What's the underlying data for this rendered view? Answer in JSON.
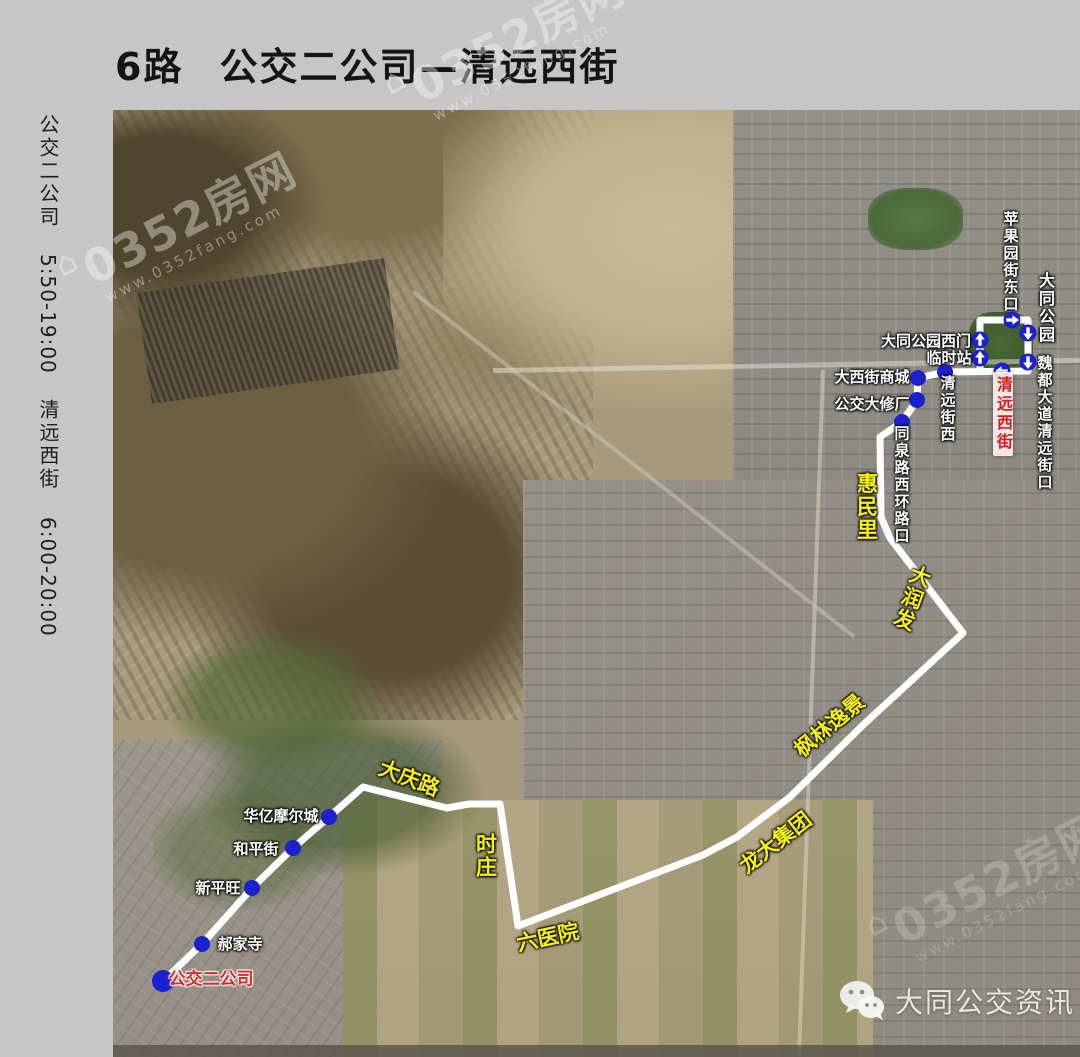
{
  "page": {
    "background": "#c6c6c6"
  },
  "header": {
    "route_no": "6路",
    "route_name": "公交二公司—清远西街"
  },
  "sidebar": {
    "start_name": "公交二公司",
    "start_hours": "5:50-19:00",
    "end_name": "清远西街",
    "end_hours": "6:00-20:00"
  },
  "watermark": {
    "icon": "⌂",
    "text": "0352房网",
    "url": "www.0352fang.com"
  },
  "footer": {
    "brand": "大同公交资讯"
  },
  "map": {
    "colors": {
      "route": "#ffffff",
      "stop": "#1b21cf",
      "station_text": "#ffffff",
      "road_text": "#f9f500",
      "terminal_text": "#e22525",
      "badge_text": "#d11f1f"
    },
    "route": {
      "main": [
        [
          50,
          871
        ],
        [
          89,
          834
        ],
        [
          139,
          778
        ],
        [
          180,
          738
        ],
        [
          216,
          707
        ],
        [
          250,
          677
        ],
        [
          334,
          698
        ],
        [
          356,
          694
        ],
        [
          387,
          694
        ],
        [
          405,
          816
        ],
        [
          590,
          745
        ],
        [
          624,
          727
        ],
        [
          677,
          687
        ],
        [
          750,
          615
        ],
        [
          850,
          523
        ],
        [
          777,
          428
        ],
        [
          768,
          407
        ],
        [
          767,
          327
        ],
        [
          789,
          312
        ],
        [
          804,
          290
        ],
        [
          805,
          268
        ],
        [
          832,
          262
        ],
        [
          915,
          261
        ]
      ],
      "loop": "M 867,261 L 867,210 L 915,210 L 915,261",
      "width": 7
    },
    "dots": [
      {
        "name": "公交二公司",
        "x": 50,
        "y": 871,
        "r": 11
      },
      {
        "name": "郝家寺",
        "x": 89,
        "y": 834,
        "r": 8
      },
      {
        "name": "新平旺",
        "x": 139,
        "y": 778,
        "r": 8
      },
      {
        "name": "和平街",
        "x": 180,
        "y": 738,
        "r": 8
      },
      {
        "name": "华亿摩尔城",
        "x": 216,
        "y": 707,
        "r": 8
      },
      {
        "name": "同泉路西环路口",
        "x": 789,
        "y": 312,
        "r": 8
      },
      {
        "name": "公交大修厂",
        "x": 804,
        "y": 290,
        "r": 8
      },
      {
        "name": "大西街商城",
        "x": 805,
        "y": 268,
        "r": 8
      },
      {
        "name": "清远街西",
        "x": 832,
        "y": 262,
        "r": 8
      },
      {
        "name": "loop-up-1",
        "x": 867,
        "y": 248,
        "r": 8.5,
        "arrow": "up"
      },
      {
        "name": "loop-up-2",
        "x": 867,
        "y": 230,
        "r": 8.5,
        "arrow": "up"
      },
      {
        "name": "loop-right",
        "x": 899,
        "y": 210,
        "r": 8.5,
        "arrow": "right"
      },
      {
        "name": "loop-down-1",
        "x": 915,
        "y": 223,
        "r": 8.5,
        "arrow": "down"
      },
      {
        "name": "loop-down-2",
        "x": 915,
        "y": 252,
        "r": 8.5,
        "arrow": "down"
      },
      {
        "name": "loop-left",
        "x": 889,
        "y": 261,
        "r": 8.5,
        "arrow": "left"
      }
    ],
    "labels": [
      {
        "text": "苹果园街东口",
        "x": 897,
        "y": 152,
        "mode": "v",
        "cls": "white",
        "size": 15
      },
      {
        "text": "大同公园",
        "x": 932,
        "y": 198,
        "mode": "v",
        "cls": "white",
        "size": 16
      },
      {
        "text": "大同公园西门",
        "x": 813,
        "y": 231,
        "mode": "h",
        "cls": "white",
        "size": 15
      },
      {
        "text": "临时站",
        "x": 836,
        "y": 248,
        "mode": "h",
        "cls": "white",
        "size": 15
      },
      {
        "text": "魏都大道清远街口",
        "x": 931,
        "y": 313,
        "mode": "v",
        "cls": "white",
        "size": 15
      },
      {
        "text": "清远西街",
        "x": 890,
        "y": 304,
        "mode": "v",
        "cls": "red-badge",
        "size": 16,
        "name": "destination-badge"
      },
      {
        "text": "大西街商城",
        "x": 759,
        "y": 267,
        "mode": "h",
        "cls": "white",
        "size": 15
      },
      {
        "text": "公交大修厂",
        "x": 759,
        "y": 294,
        "mode": "h",
        "cls": "white",
        "size": 15
      },
      {
        "text": "清远街西",
        "x": 834,
        "y": 299,
        "mode": "v",
        "cls": "white",
        "size": 15
      },
      {
        "text": "同泉路西环路口",
        "x": 788,
        "y": 375,
        "mode": "v",
        "cls": "white",
        "size": 15
      },
      {
        "text": "惠民里",
        "x": 753,
        "y": 397,
        "mode": "v",
        "cls": "yellow",
        "size": 21
      },
      {
        "text": "大润发",
        "x": 798,
        "y": 488,
        "mode": "v",
        "cls": "yellow",
        "size": 21,
        "rot": 20
      },
      {
        "text": "枫林逸景",
        "x": 717,
        "y": 616,
        "mode": "h",
        "cls": "yellow",
        "size": 21,
        "rot": -40
      },
      {
        "text": "龙大集团",
        "x": 663,
        "y": 733,
        "mode": "h",
        "cls": "yellow",
        "size": 21,
        "rot": -38
      },
      {
        "text": "六医院",
        "x": 435,
        "y": 828,
        "mode": "h",
        "cls": "yellow",
        "size": 21,
        "rot": -12
      },
      {
        "text": "时庄",
        "x": 372,
        "y": 746,
        "mode": "v",
        "cls": "yellow",
        "size": 21
      },
      {
        "text": "大庆路",
        "x": 296,
        "y": 669,
        "mode": "h",
        "cls": "yellow",
        "size": 21,
        "rot": 21
      },
      {
        "text": "华亿摩尔城",
        "x": 168,
        "y": 706,
        "mode": "h",
        "cls": "white",
        "size": 15
      },
      {
        "text": "和平街",
        "x": 143,
        "y": 739,
        "mode": "h",
        "cls": "white",
        "size": 15
      },
      {
        "text": "新平旺",
        "x": 105,
        "y": 778,
        "mode": "h",
        "cls": "white",
        "size": 15
      },
      {
        "text": "郝家寺",
        "x": 127,
        "y": 834,
        "mode": "h",
        "cls": "white",
        "size": 15
      },
      {
        "text": "公交二公司",
        "x": 98,
        "y": 870,
        "mode": "h",
        "cls": "red",
        "size": 17,
        "name": "terminal-label"
      }
    ]
  }
}
